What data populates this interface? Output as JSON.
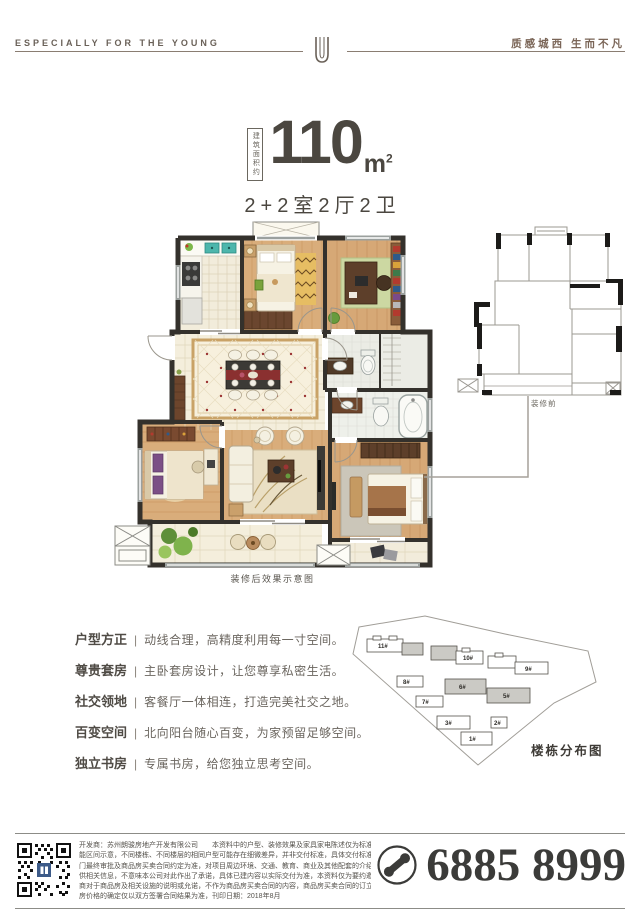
{
  "header": {
    "left_tagline": "ESPECIALLY FOR THE YOUNG",
    "right_tagline": "质感城西 生而不凡",
    "logo_icon": "double-u-emblem"
  },
  "headline": {
    "area_label_vertical": "建筑面积约",
    "area_value": "110",
    "area_unit": "m",
    "area_unit_sup": "2",
    "layout": "2+2室2厅2卫"
  },
  "floorplan": {
    "after_caption": "装修后效果示意图",
    "before_label": "装修前"
  },
  "features_separator": "|",
  "features": [
    {
      "label": "户型方正",
      "desc": "动线合理，高精度利用每一寸空间。"
    },
    {
      "label": "尊贵套房",
      "desc": "主卧套房设计，让您尊享私密生活。"
    },
    {
      "label": "社交领地",
      "desc": "客餐厅一体相连，打造完美社交之地。"
    },
    {
      "label": "百变空间",
      "desc": "北向阳台随心百变，为家预留足够空间。"
    },
    {
      "label": "独立书房",
      "desc": "专属书房，给您独立思考空间。"
    }
  ],
  "siteplan": {
    "title": "楼栋分布图",
    "buildings": [
      {
        "label": "11#"
      },
      {
        "label": "10#"
      },
      {
        "label": "9#"
      },
      {
        "label": "8#"
      },
      {
        "label": "6#"
      },
      {
        "label": "5#"
      },
      {
        "label": "7#"
      },
      {
        "label": "3#"
      },
      {
        "label": "2#"
      },
      {
        "label": "1#"
      }
    ]
  },
  "footer": {
    "disclaimer_lines": [
      "开发商：苏州朗骏房地产开发有限公司　　本资料中的户型、装修效果及家具家电陈述仅为标准层商品房功",
      "能区间示意，不同楼栋、不同楼层的相同户型可能存在细微差异，并非交付标准，具体交付标准以政府部",
      "门最终审批及商品房买卖合同约定为准，对项目周边环境、交通、教育、商业及其他配套的介绍，旨在提",
      "供相关信息，不意味本公司对此作出了承诺，具体已建内容以实际交付为准，本资料仅为要约邀请，并非开发",
      "商对于商品房及相关设施的说明或允诺，不作为商品房买卖合同的内容，商品房买卖合同的订立以及商品",
      "房价格的确定仅以双方签署合同结果为准，刊印日期：2018年8月"
    ],
    "phone": "6885 8999",
    "phone_icon": "phone-receiver-circle",
    "qr_icon": "qr-code"
  },
  "colors": {
    "accent_dark": "#4b4740",
    "header_brown": "#7a6557",
    "wall": "#34312c",
    "wood_floor": "#d8ab79",
    "tile_floor": "#f3ecd8",
    "carpet_border": "#c9a266",
    "phone_text": "#3b3b39",
    "qr_logo_blue": "#3c5a88"
  }
}
